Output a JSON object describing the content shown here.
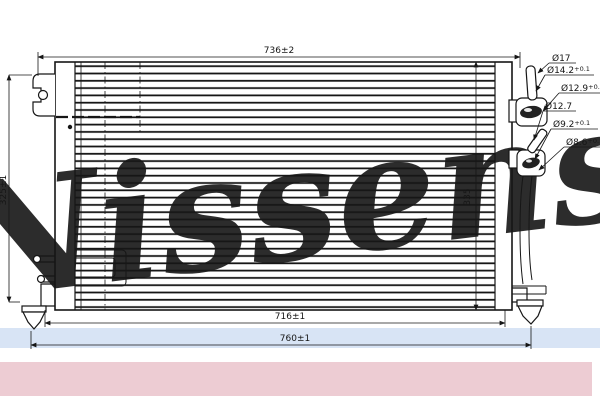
{
  "watermark": {
    "brand": "Nissens"
  },
  "dimensions": {
    "top_width": "736±2",
    "left_height": "325±1",
    "right_height": "335",
    "bottom_inner_width": "716±1",
    "bottom_outer_width": "760±1"
  },
  "fitting_labels": {
    "top_port": [
      {
        "main": "Ø17",
        "tol": ""
      },
      {
        "main": "Ø14.2",
        "tol": "+0.1"
      },
      {
        "main": "Ø12.9",
        "tol": "+0.1"
      }
    ],
    "bottom_port": [
      {
        "main": "Ø12.7",
        "tol": ""
      },
      {
        "main": "Ø9.2",
        "tol": "+0.1"
      },
      {
        "main": "Ø8.6",
        "tol": "+0.1"
      }
    ]
  },
  "colors": {
    "line": "#161616",
    "watermark": "#b9cfe9",
    "band": "#ccdcf2",
    "strip": "#edccd3",
    "background": "#ffffff"
  }
}
